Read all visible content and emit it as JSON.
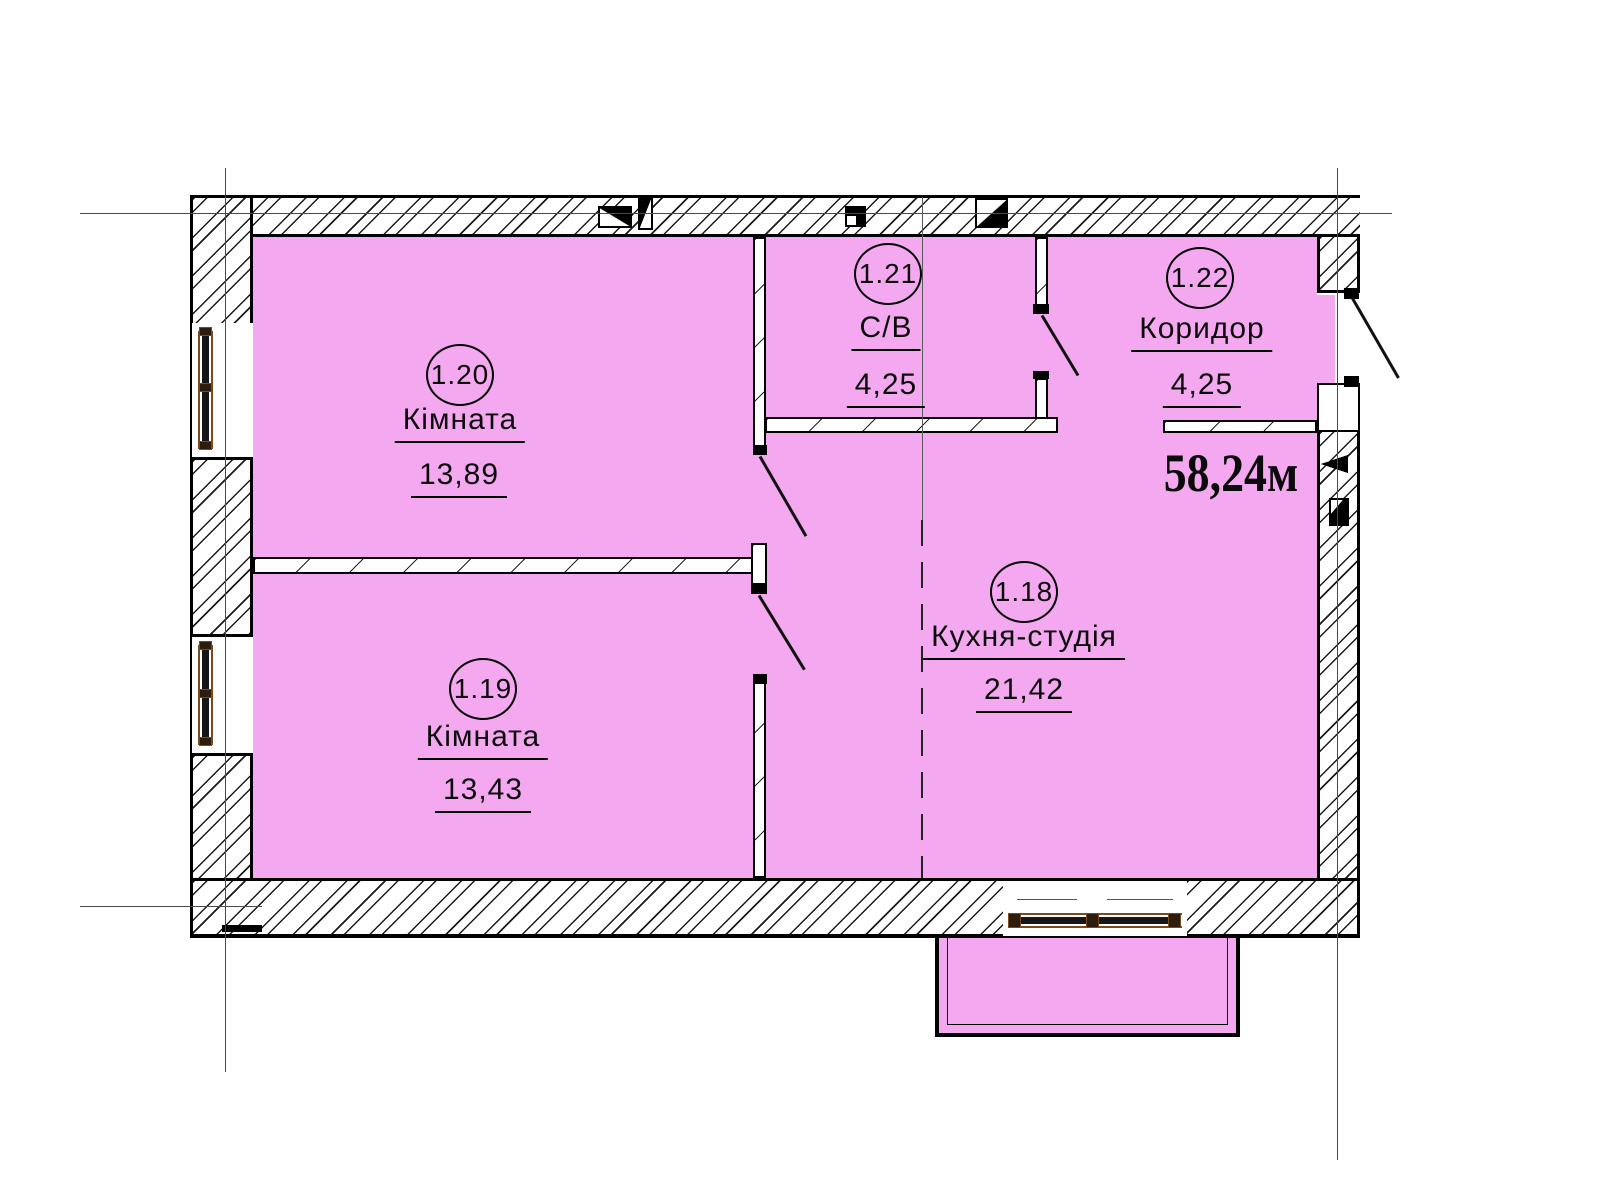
{
  "plan": {
    "type": "apartment-floor-plan",
    "total_area_label": "58,24м",
    "rooms": [
      {
        "id": "1.20",
        "name": "Кімната",
        "area": "13,89"
      },
      {
        "id": "1.19",
        "name": "Кімната",
        "area": "13,43"
      },
      {
        "id": "1.21",
        "name": "С/В",
        "area": "4,25"
      },
      {
        "id": "1.22",
        "name": "Коридор",
        "area": "4,25"
      },
      {
        "id": "1.18",
        "name": "Кухня-студія",
        "area": "21,42"
      }
    ],
    "colors": {
      "room_fill": "#F4A8F0",
      "wall_line": "#000000",
      "window_frame_accent": "#7A4A1E"
    },
    "features": [
      "entry-door",
      "bathroom-door",
      "room-doors",
      "balcony",
      "windows",
      "vent-shafts",
      "axis-lines"
    ]
  }
}
